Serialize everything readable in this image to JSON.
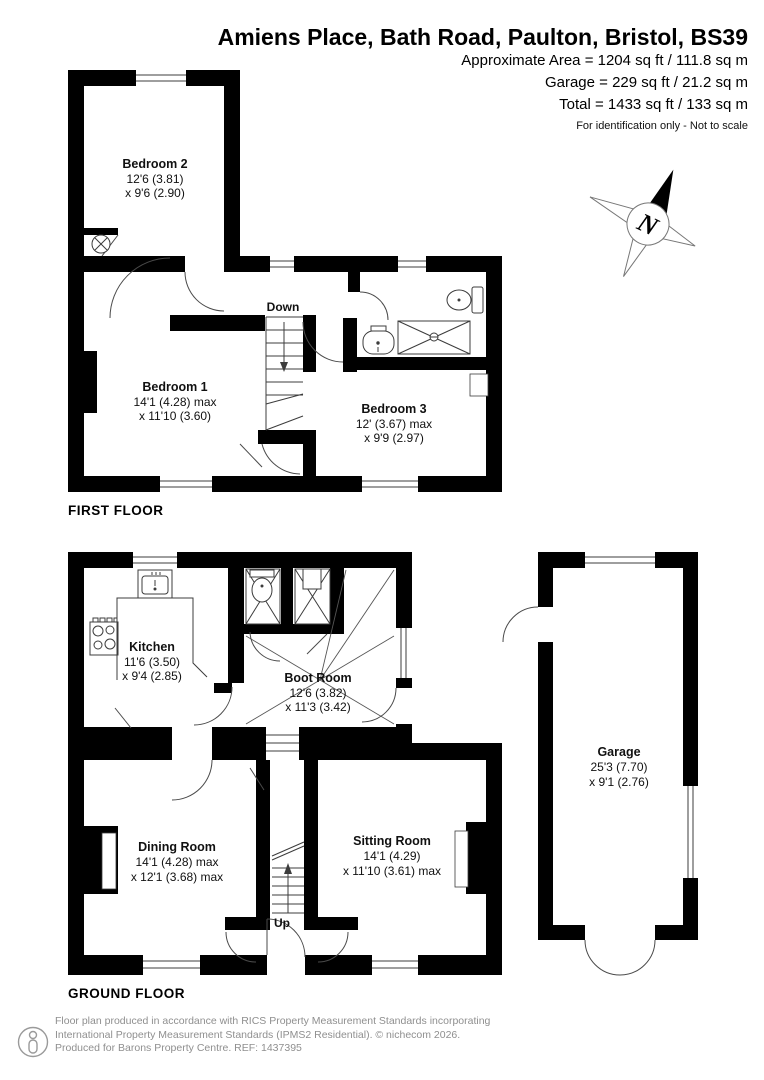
{
  "header": {
    "title": "Amiens Place, Bath Road, Paulton, Bristol, BS39",
    "area_lines": [
      "Approximate Area = 1204 sq ft / 111.8 sq m",
      "Garage = 229 sq ft / 21.2 sq m",
      "Total = 1433 sq ft / 133 sq m"
    ],
    "disclaimer": "For identification only - Not to scale"
  },
  "floors": {
    "first": {
      "label": "FIRST FLOOR",
      "stairs_label": "Down",
      "rooms": [
        {
          "name": "Bedroom 2",
          "dim1": "12'6 (3.81)",
          "dim2": "x 9'6 (2.90)"
        },
        {
          "name": "Bedroom 1",
          "dim1": "14'1 (4.28) max",
          "dim2": "x 11'10 (3.60)"
        },
        {
          "name": "Bedroom 3",
          "dim1": "12' (3.67) max",
          "dim2": "x 9'9 (2.97)"
        }
      ]
    },
    "ground": {
      "label": "GROUND FLOOR",
      "stairs_label": "Up",
      "rooms": [
        {
          "name": "Kitchen",
          "dim1": "11'6 (3.50)",
          "dim2": "x 9'4 (2.85)"
        },
        {
          "name": "Boot Room",
          "dim1": "12'6 (3.82)",
          "dim2": "x 11'3 (3.42)"
        },
        {
          "name": "Dining Room",
          "dim1": "14'1 (4.28) max",
          "dim2": "x 12'1 (3.68) max"
        },
        {
          "name": "Sitting Room",
          "dim1": "14'1 (4.29)",
          "dim2": "x 11'10 (3.61) max"
        },
        {
          "name": "Garage",
          "dim1": "25'3 (7.70)",
          "dim2": "x 9'1 (2.76)"
        }
      ]
    }
  },
  "compass": {
    "letter": "N"
  },
  "footer": {
    "line1": "Floor plan produced in accordance with RICS Property Measurement Standards incorporating",
    "line2": "International Property Measurement Standards (IPMS2 Residential).   © nichecom 2026.",
    "line3": "Produced for Barons Property Centre.   REF: 1437395"
  },
  "colors": {
    "wall": "#000000",
    "thin_line": "#3c3c3c",
    "footer_text": "#8f8f8f"
  }
}
